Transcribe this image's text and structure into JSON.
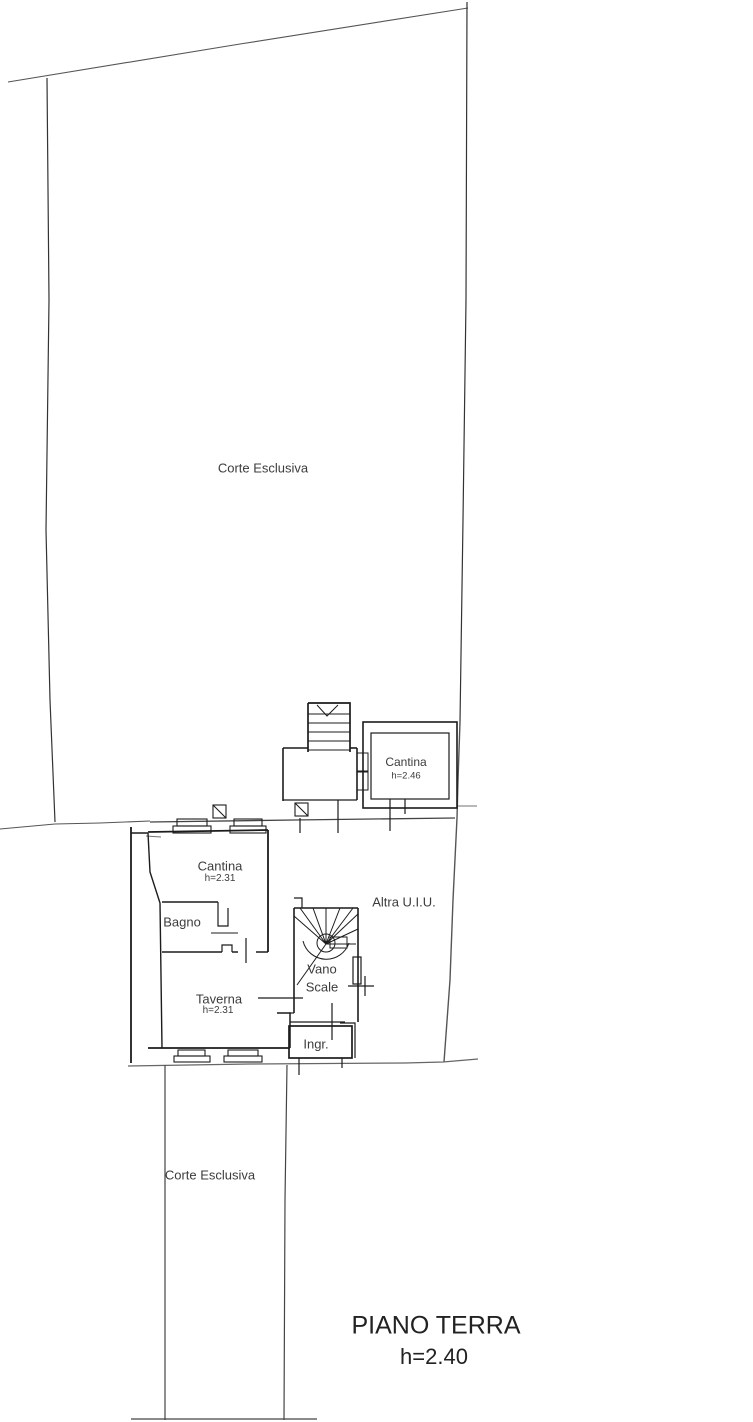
{
  "labels": {
    "corte_top": "Corte Esclusiva",
    "cantina_small_name": "Cantina",
    "cantina_small_height": "h=2.46",
    "cantina_large_name": "Cantina",
    "cantina_large_height": "h=2.31",
    "bagno": "Bagno",
    "altra_uiu": "Altra U.I.U.",
    "vano_scale_line1": "Vano",
    "vano_scale_line2": "Scale",
    "taverna_name": "Taverna",
    "taverna_height": "h=2.31",
    "ingresso": "Ingr.",
    "corte_bottom": "Corte Esclusiva"
  },
  "title": {
    "main": "PIANO TERRA",
    "height": "h=2.40"
  },
  "colors": {
    "background": "#ffffff",
    "wall_line": "#1c1c1c",
    "site_line": "#707070",
    "text": "#3c3c3c"
  }
}
